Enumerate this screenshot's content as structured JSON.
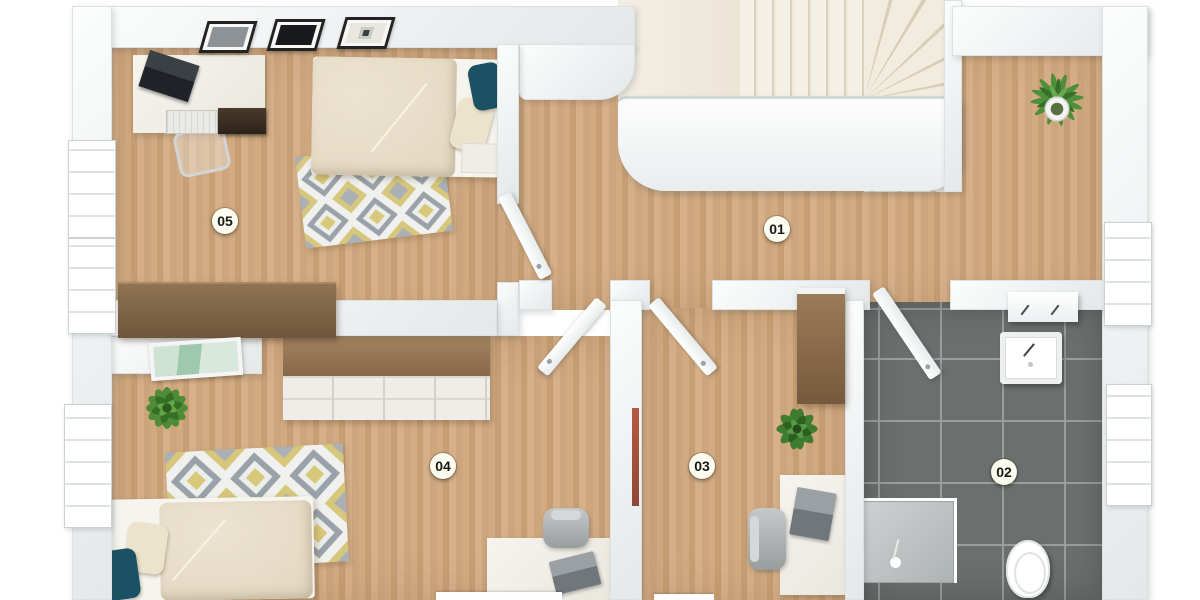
{
  "floorplan": {
    "rooms": [
      {
        "id": "room-01",
        "label": "01"
      },
      {
        "id": "room-02",
        "label": "02"
      },
      {
        "id": "room-03",
        "label": "03"
      },
      {
        "id": "room-04",
        "label": "04"
      },
      {
        "id": "room-05",
        "label": "05"
      }
    ],
    "colors": {
      "wood_floor": "#d2ab82",
      "wood_seam": "#c09a72",
      "bathroom_tile": "#6b706f",
      "tile_grout": "#999f9d",
      "wall": "#f2f4f4",
      "wall_edge": "#dde1e2",
      "stair_tread": "#f0e9dc",
      "stair_tread_edge": "#d9cdb8",
      "rug_gray": "#9aa1a8",
      "rug_yellow": "#d8c87a",
      "duvet_beige": "#e8dfcb",
      "accent_pillow_teal": "#1a5163",
      "plant_green": "#4e8c37",
      "label_background": "#fcfcf0",
      "label_text": "#181818"
    }
  }
}
